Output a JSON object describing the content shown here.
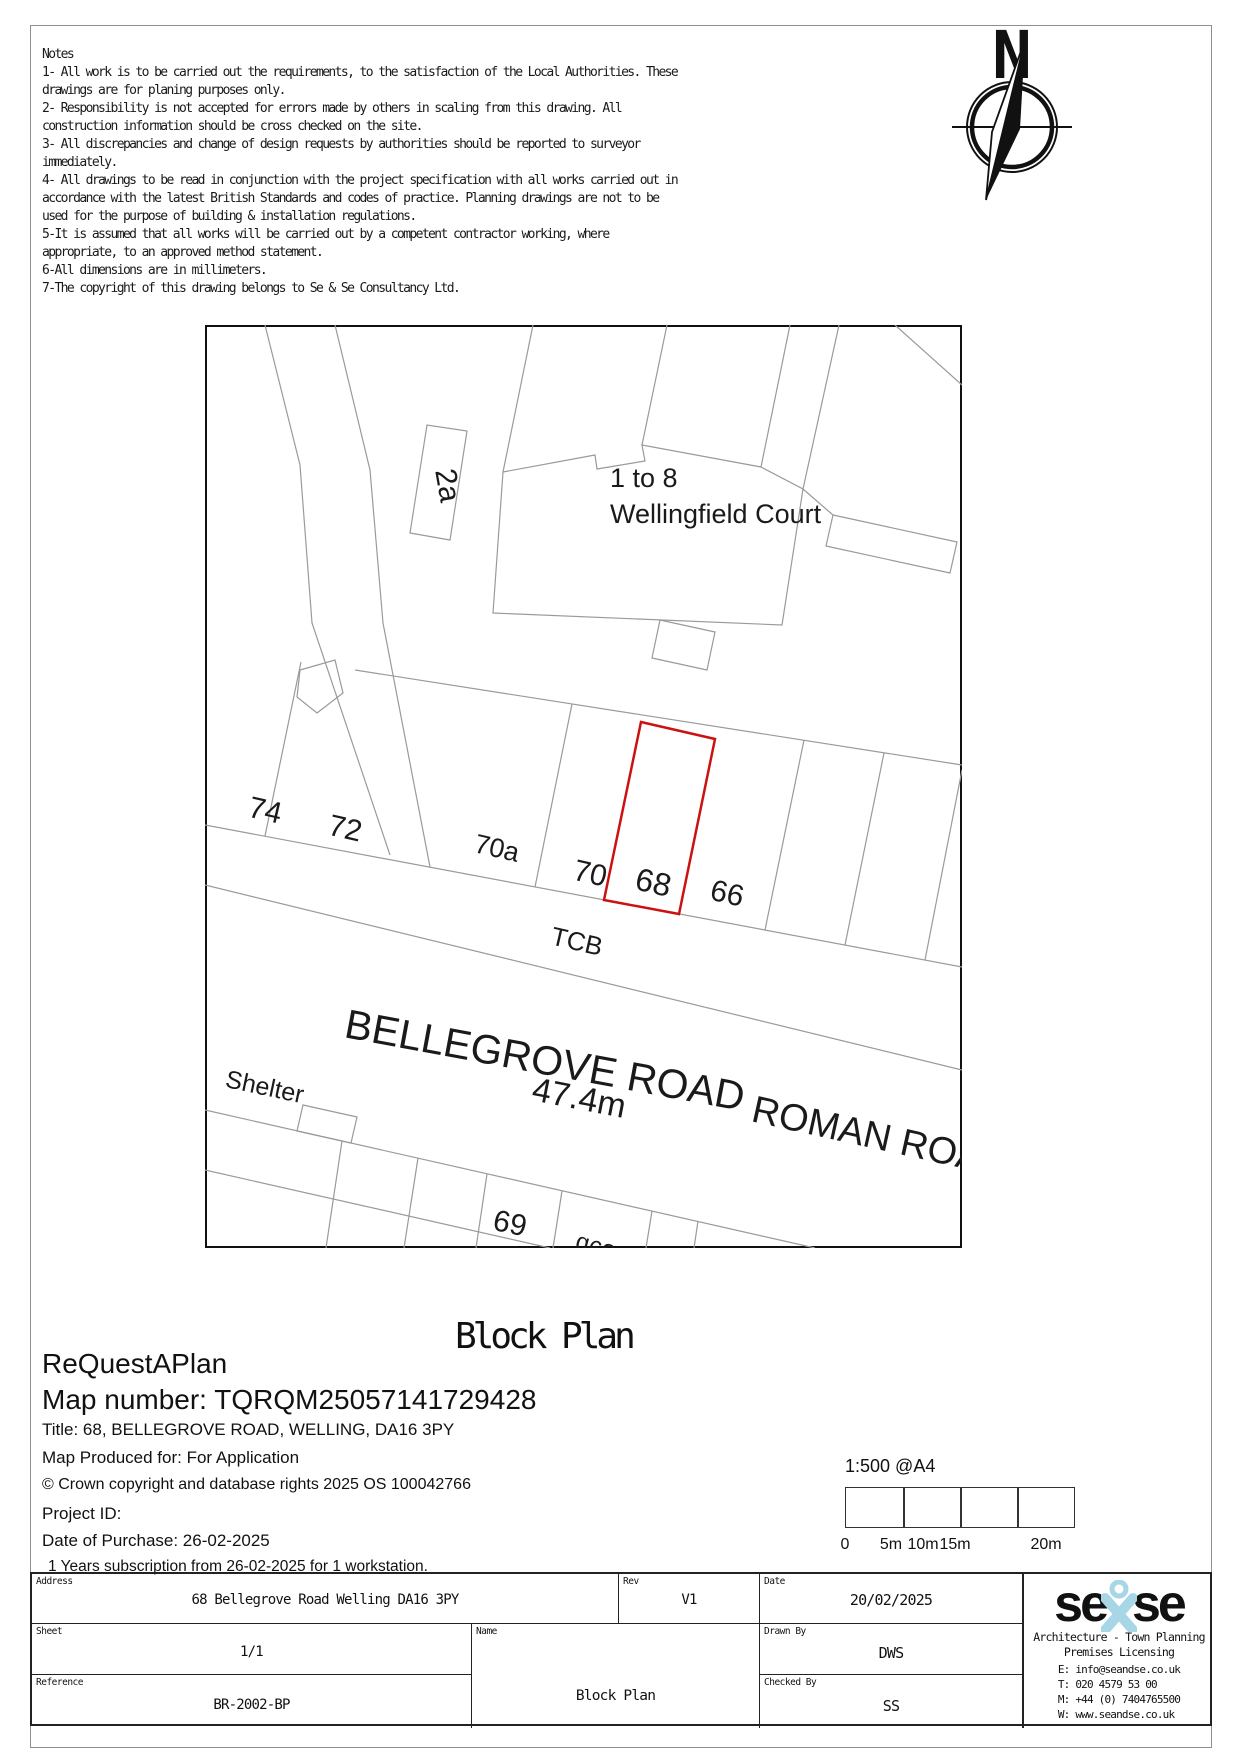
{
  "notes": {
    "title": "Notes",
    "lines": [
      "1- All work is to be carried out the requirements, to the satisfaction of the Local Authorities. These",
      "drawings are for planing purposes only.",
      "2- Responsibility is not accepted for errors made by others in scaling from this drawing. All",
      "construction information should be cross checked on the site.",
      "3- All discrepancies and change of design requests by authorities should be reported to surveyor",
      "immediately.",
      "4- All drawings to be read in conjunction with the project specification with all works carried out in",
      "accordance with the latest British Standards and codes of practice. Planning drawings are not to be",
      "used for the purpose of building & installation regulations.",
      "5-It is assumed that all works will be carried out by a competent contractor working, where",
      "appropriate, to an approved method statement.",
      "6-All dimensions are in millimeters.",
      "7-The copyright of this drawing belongs to Se & Se Consultancy Ltd."
    ]
  },
  "compass": {
    "north": "N"
  },
  "map": {
    "labels": {
      "unit_range": "1 to 8",
      "building": "Wellingfield Court",
      "plot_2a": "2a",
      "n74": "74",
      "n72": "72",
      "n70a": "70a",
      "n70": "70",
      "n68": "68",
      "n66": "66",
      "tcb": "TCB",
      "road1": "BELLEGROVE ROAD",
      "road2": "ROMAN ROAD",
      "distance": "47.4m",
      "shelter": "Shelter",
      "n69": "69",
      "n59b": "59b"
    }
  },
  "titles": {
    "block_plan": "Block Plan",
    "brand": "ReQuestAPlan",
    "map_number": "Map number: TQRQM25057141729428"
  },
  "details": {
    "title_line": "Title: 68, BELLEGROVE ROAD, WELLING, DA16 3PY",
    "produced_for": "Map Produced for: For Application",
    "copyright": "© Crown copyright and database rights 2025 OS 100042766",
    "project_id": "Project ID:",
    "purchase_date": "Date of Purchase: 26-02-2025",
    "subscription": "1 Years subscription from 26-02-2025 for 1 workstation."
  },
  "scale": {
    "caption": "1:500 @A4",
    "t0": "0",
    "t1": "5m",
    "t2": "10m",
    "t3": "15m",
    "t4": "20m"
  },
  "title_block": {
    "address_label": "Address",
    "address": "68 Bellegrove Road Welling DA16 3PY",
    "rev_label": "Rev",
    "rev": "V1",
    "date_label": "Date",
    "date": "20/02/2025",
    "sheet_label": "Sheet",
    "sheet": "1/1",
    "name_label": "Name",
    "name": "Block Plan",
    "drawn_label": "Drawn By",
    "drawn": "DWS",
    "reference_label": "Reference",
    "reference": "BR-2002-BP",
    "checked_label": "Checked By",
    "checked": "SS"
  },
  "logo": {
    "word1": "se",
    "word2": "se",
    "tagline1": "Architecture - Town Planning",
    "tagline2": "Premises Licensing",
    "email": "E: info@seandse.co.uk",
    "phone": "T: 020 4579 53 00",
    "mobile": "M: +44 (0) 7404765500",
    "web": "W: www.seandse.co.uk"
  },
  "colors": {
    "plot_red": "#cc1111",
    "map_gray": "#9a9a9a",
    "logo_blue": "#a7d6e7"
  }
}
